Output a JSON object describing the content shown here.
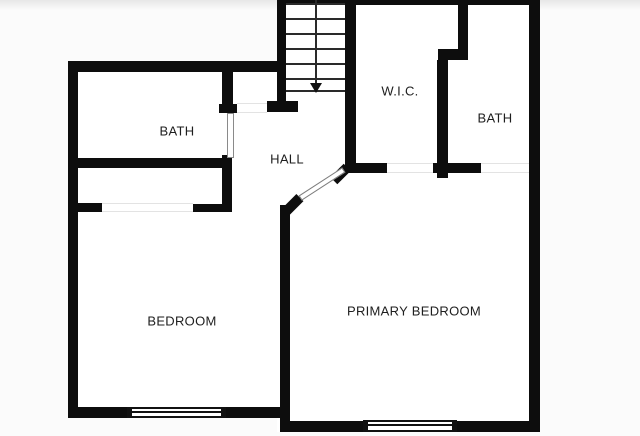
{
  "floor_plan": {
    "title": "Upper floor plan",
    "colors": {
      "wall": "#0d0d0d",
      "floor": "#ffffff",
      "background": "#fafafa"
    },
    "rooms": [
      {
        "id": "bath-left",
        "label": "BATH"
      },
      {
        "id": "hall",
        "label": "HALL"
      },
      {
        "id": "wic",
        "label": "W.I.C."
      },
      {
        "id": "bath-right",
        "label": "BATH"
      },
      {
        "id": "bedroom",
        "label": "BEDROOM"
      },
      {
        "id": "primary-bedroom",
        "label": "PRIMARY BEDROOM"
      }
    ],
    "stairs": {
      "direction": "down",
      "tread_count": 7
    },
    "window_count": 2,
    "door_openings": [
      "bath-left",
      "hall-closet",
      "bedroom-closet",
      "primary-bedroom",
      "wic",
      "bath-right"
    ]
  }
}
